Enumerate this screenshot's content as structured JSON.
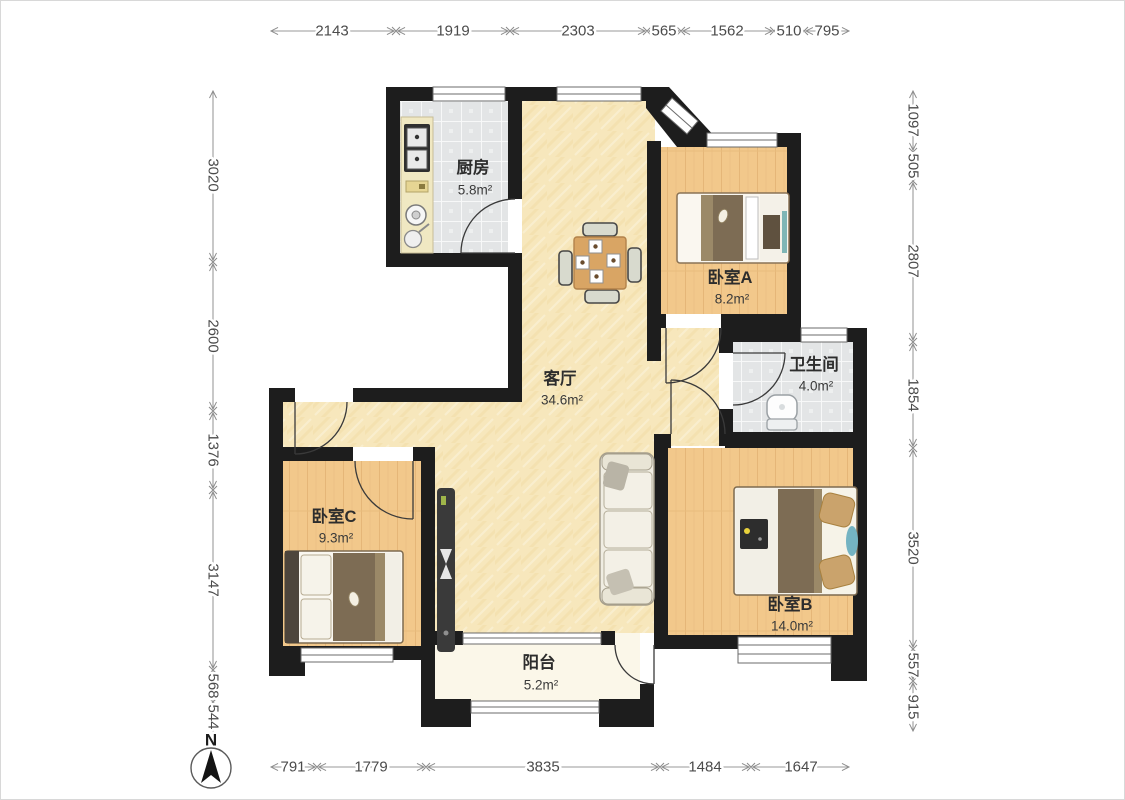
{
  "image_type": "apartment-floor-plan",
  "north_label": "N",
  "rooms": [
    {
      "name": "厨房",
      "area": "5.8m²"
    },
    {
      "name": "卧室A",
      "area": "8.2m²"
    },
    {
      "name": "卫生间",
      "area": "4.0m²"
    },
    {
      "name": "客厅",
      "area": "34.6m²"
    },
    {
      "name": "卧室C",
      "area": "9.3m²"
    },
    {
      "name": "卧室B",
      "area": "14.0m²"
    },
    {
      "name": "阳台",
      "area": "5.2m²"
    }
  ],
  "dimensions": {
    "top": [
      "2143",
      "1919",
      "2303",
      "565",
      "1562",
      "510",
      "795"
    ],
    "bottom": [
      "791",
      "1779",
      "3835",
      "1484",
      "1647"
    ],
    "left": [
      "3020",
      "2600",
      "1376",
      "3147",
      "568",
      "544"
    ],
    "right": [
      "1097",
      "505",
      "2807",
      "1854",
      "3520",
      "557",
      "915"
    ]
  },
  "colors": {
    "wall": "#1d1d1d",
    "wood_floor": "#f2c88b",
    "tile_floor": "#e3e5e6",
    "living_floor": "#f7e7bc",
    "balcony_floor": "#fbf7e9",
    "bedding_brown": "#7d6c54",
    "dimension_text": "#4b4b4b"
  }
}
